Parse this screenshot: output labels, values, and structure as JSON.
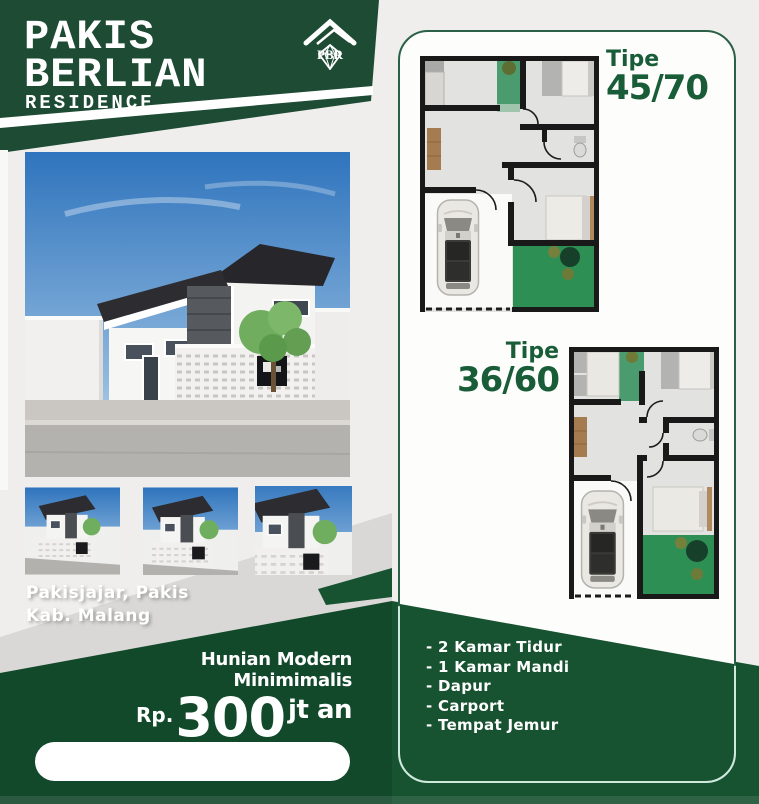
{
  "brand": {
    "line1": "PAKIS",
    "line2": "BERLIAN",
    "tagline": "RESIDENCE",
    "logo": "PBR"
  },
  "location": {
    "line1": "Pakisjajar, Pakis",
    "line2": "Kab. Malang"
  },
  "offer": {
    "headline": "Hunian Modern Minimimalis",
    "currency": "Rp.",
    "amount": "300",
    "unit": "jt an"
  },
  "plan1": {
    "label": "Tipe",
    "size": "45/70"
  },
  "plan2": {
    "label": "Tipe",
    "size": "36/60"
  },
  "features": [
    "- 2 Kamar Tidur",
    "- 1 Kamar Mandi",
    "- Dapur",
    "- Carport",
    "- Tempat Jemur"
  ],
  "colors": {
    "header_green": "#1d4b33",
    "footer_green_left": "#12492b",
    "footer_green_right": "#175231",
    "text_green": "#185c38",
    "panel_border": "#2a6045",
    "mint_border": "#cfeadd",
    "page_bg": "#efeeec",
    "gray_wedge": "#d9d8d6",
    "garden_green": "#2e8f55"
  }
}
